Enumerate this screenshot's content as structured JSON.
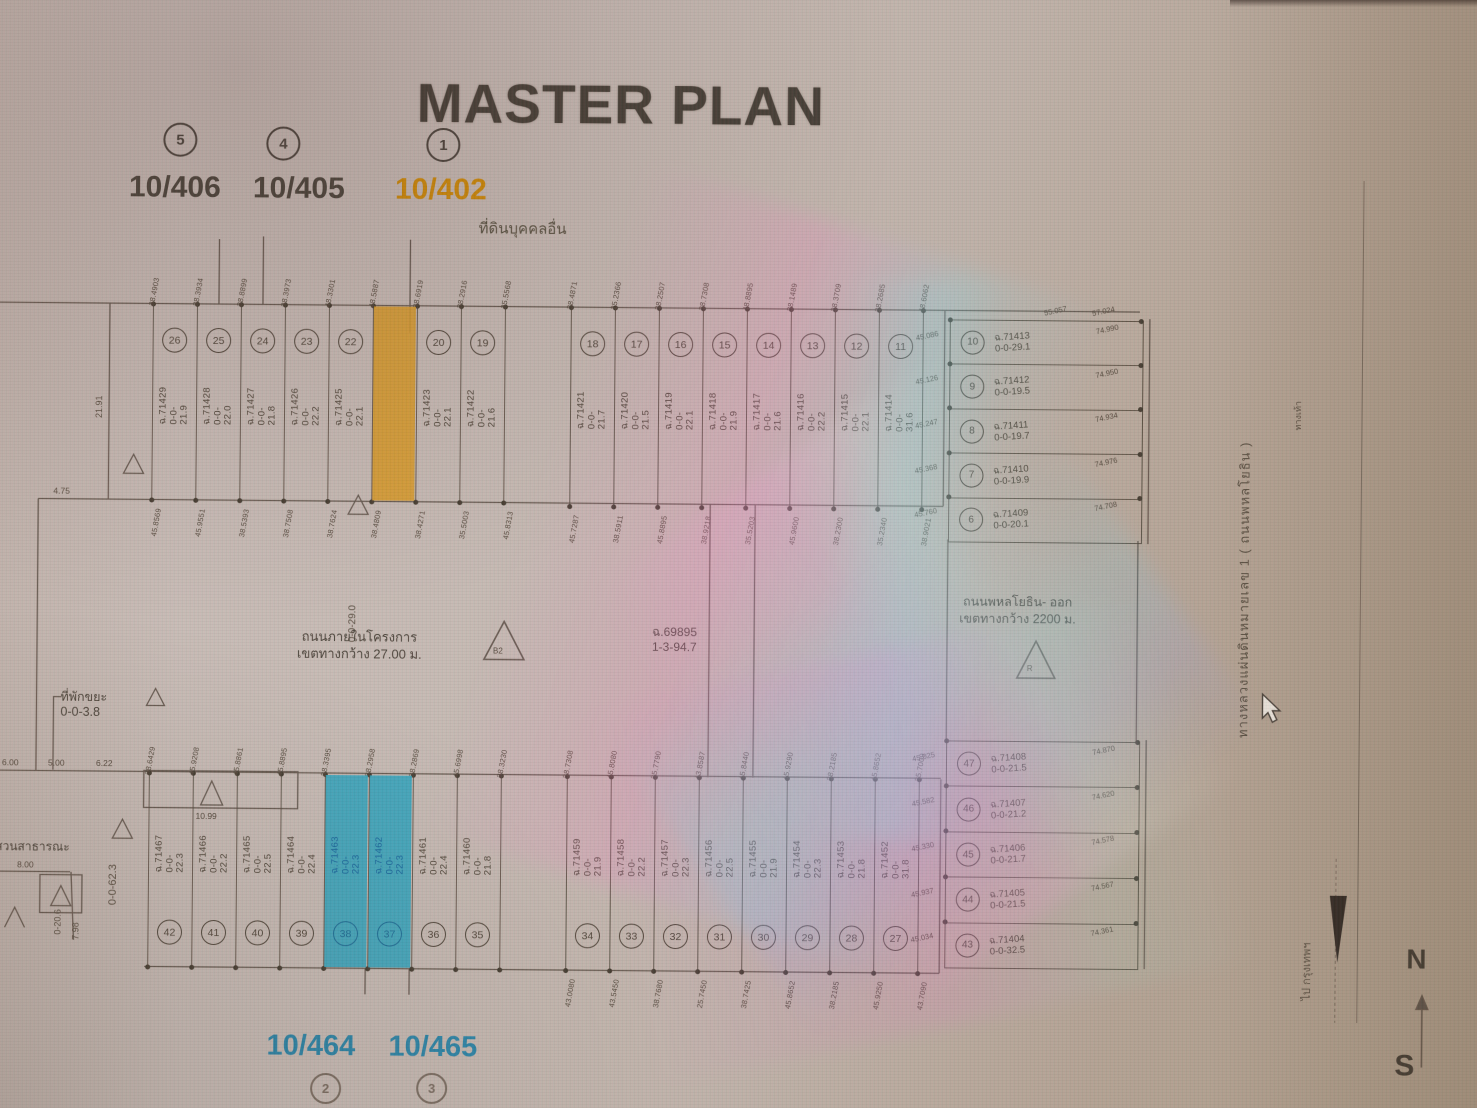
{
  "header": {
    "title": "MASTER PLAN",
    "neighbor_label": "ที่ดินบุคคลอื่น"
  },
  "markers_top": [
    {
      "no": "5",
      "label": "10/406",
      "style": "dark"
    },
    {
      "no": "4",
      "label": "10/405",
      "style": "dark"
    },
    {
      "no": "1",
      "label": "10/402",
      "style": "orange"
    }
  ],
  "markers_bottom": [
    {
      "no": "2",
      "label": "10/464"
    },
    {
      "no": "3",
      "label": "10/465"
    }
  ],
  "colors": {
    "highlight_orange": "#d79a2a",
    "highlight_teal": "#35a3bb",
    "teal_text": "#17669c",
    "orange_text": "#cf8a05",
    "line": "#55493e"
  },
  "lots": {
    "top_left": [
      {
        "no": "26",
        "deed": "ฉ.71429",
        "area": "0-0-21.9",
        "hl": ""
      },
      {
        "no": "25",
        "deed": "ฉ.71428",
        "area": "0-0-22.0",
        "hl": ""
      },
      {
        "no": "24",
        "deed": "ฉ.71427",
        "area": "0-0-21.8",
        "hl": ""
      },
      {
        "no": "23",
        "deed": "ฉ.71426",
        "area": "0-0-22.2",
        "hl": ""
      },
      {
        "no": "22",
        "deed": "ฉ.71425",
        "area": "0-0-22.1",
        "hl": ""
      },
      {
        "no": "",
        "deed": "",
        "area": "",
        "hl": "orange"
      },
      {
        "no": "20",
        "deed": "ฉ.71423",
        "area": "0-0-22.1",
        "hl": ""
      },
      {
        "no": "19",
        "deed": "ฉ.71422",
        "area": "0-0-21.6",
        "hl": ""
      }
    ],
    "top_right": [
      {
        "no": "18",
        "deed": "ฉ.71421",
        "area": "0-0-21.7",
        "hl": ""
      },
      {
        "no": "17",
        "deed": "ฉ.71420",
        "area": "0-0-21.5",
        "hl": ""
      },
      {
        "no": "16",
        "deed": "ฉ.71419",
        "area": "0-0-22.1",
        "hl": ""
      },
      {
        "no": "15",
        "deed": "ฉ.71418",
        "area": "0-0-21.9",
        "hl": ""
      },
      {
        "no": "14",
        "deed": "ฉ.71417",
        "area": "0-0-21.6",
        "hl": ""
      },
      {
        "no": "13",
        "deed": "ฉ.71416",
        "area": "0-0-22.2",
        "hl": ""
      },
      {
        "no": "12",
        "deed": "ฉ.71415",
        "area": "0-0-22.1",
        "hl": ""
      },
      {
        "no": "11",
        "deed": "ฉ.71414",
        "area": "0-0-31.6",
        "hl": ""
      }
    ],
    "bottom_left": [
      {
        "no": "42",
        "deed": "ฉ.71467",
        "area": "0-0-22.3",
        "hl": ""
      },
      {
        "no": "41",
        "deed": "ฉ.71466",
        "area": "0-0-22.2",
        "hl": ""
      },
      {
        "no": "40",
        "deed": "ฉ.71465",
        "area": "0-0-22.5",
        "hl": ""
      },
      {
        "no": "39",
        "deed": "ฉ.71464",
        "area": "0-0-22.4",
        "hl": ""
      },
      {
        "no": "38",
        "deed": "ฉ.71463",
        "area": "0-0-22.3",
        "hl": "teal"
      },
      {
        "no": "37",
        "deed": "ฉ.71462",
        "area": "0-0-22.3",
        "hl": "teal"
      },
      {
        "no": "36",
        "deed": "ฉ.71461",
        "area": "0-0-22.4",
        "hl": ""
      },
      {
        "no": "35",
        "deed": "ฉ.71460",
        "area": "0-0-21.8",
        "hl": ""
      }
    ],
    "bottom_right": [
      {
        "no": "34",
        "deed": "ฉ.71459",
        "area": "0-0-21.9",
        "hl": ""
      },
      {
        "no": "33",
        "deed": "ฉ.71458",
        "area": "0-0-22.2",
        "hl": ""
      },
      {
        "no": "32",
        "deed": "ฉ.71457",
        "area": "0-0-22.3",
        "hl": ""
      },
      {
        "no": "31",
        "deed": "ฉ.71456",
        "area": "0-0-22.5",
        "hl": ""
      },
      {
        "no": "30",
        "deed": "ฉ.71455",
        "area": "0-0-21.9",
        "hl": ""
      },
      {
        "no": "29",
        "deed": "ฉ.71454",
        "area": "0-0-22.3",
        "hl": ""
      },
      {
        "no": "28",
        "deed": "ฉ.71453",
        "area": "0-0-21.8",
        "hl": ""
      },
      {
        "no": "27",
        "deed": "ฉ.71452",
        "area": "0-0-31.8",
        "hl": ""
      }
    ],
    "block_top_right": [
      {
        "no": "10",
        "deed": "ฉ.71413",
        "area": "0-0-29.1"
      },
      {
        "no": "9",
        "deed": "ฉ.71412",
        "area": "0-0-19.5"
      },
      {
        "no": "8",
        "deed": "ฉ.71411",
        "area": "0-0-19.7"
      },
      {
        "no": "7",
        "deed": "ฉ.71410",
        "area": "0-0-19.9"
      },
      {
        "no": "6",
        "deed": "ฉ.71409",
        "area": "0-0-20.1"
      }
    ],
    "block_bottom_right": [
      {
        "no": "47",
        "deed": "ฉ.71408",
        "area": "0-0-21.5"
      },
      {
        "no": "46",
        "deed": "ฉ.71407",
        "area": "0-0-21.2"
      },
      {
        "no": "45",
        "deed": "ฉ.71406",
        "area": "0-0-21.7"
      },
      {
        "no": "44",
        "deed": "ฉ.71405",
        "area": "0-0-21.5"
      },
      {
        "no": "43",
        "deed": "ฉ.71404",
        "area": "0-0-32.5"
      }
    ]
  },
  "ticks": {
    "top_left_above": [
      "38.4903",
      "38.3934",
      "38.8899",
      "38.3973",
      "48.3301",
      "48.5887",
      "38.6919",
      "38.2916",
      "35.5568"
    ],
    "top_right_above": [
      "38.4871",
      "25.2366",
      "38.2507",
      "38.7308",
      "48.8895",
      "38.1489",
      "38.3709",
      "38.2685",
      "48.6062"
    ],
    "top_left_below": [
      "45.8569",
      "45.9551",
      "38.5393",
      "38.7508",
      "38.7624",
      "38.4809",
      "38.4271",
      "35.5003",
      "45.8313"
    ],
    "top_right_below": [
      "45.7287",
      "38.5911",
      "45.8895",
      "38.9218",
      "35.5203",
      "45.9600",
      "38.2300",
      "35.2340",
      "38.9021"
    ],
    "bottom_left_above": [
      "38.6429",
      "45.9208",
      "45.8861",
      "45.8895",
      "38.3395",
      "38.2958",
      "38.2869",
      "45.6998",
      "38.3230"
    ],
    "bottom_right_above": [
      "38.7308",
      "45.8080",
      "25.7790",
      "43.8587",
      "45.8440",
      "45.9290",
      "38.2185",
      "45.8652",
      "25.7009"
    ],
    "bottom_right_below": [
      "43.0080",
      "43.5450",
      "38.7680",
      "25.7450",
      "38.7425",
      "45.8652",
      "38.2185",
      "45.9250",
      "43.7090"
    ],
    "btr_left": [
      "45.086",
      "45.126",
      "45.247",
      "45.368",
      "45.760"
    ],
    "btr_right": [
      "74.990",
      "74.950",
      "74.934",
      "74.976",
      "74.708"
    ],
    "btr_top": [
      "55.057",
      "57.024"
    ],
    "bbr_left": [
      "45.025",
      "45.582",
      "45.330",
      "45.937",
      "45.034"
    ],
    "bbr_right": [
      "74.870",
      "74.620",
      "74.578",
      "74.567",
      "74.361"
    ]
  },
  "roads": {
    "internal": {
      "line1": "ถนนภายในโครงการ",
      "line2": "เขตทางกว้าง 27.00 ม.",
      "sym": "B2"
    },
    "exit": {
      "line1": "ถนนพหลโยธิน- ออก",
      "line2": "เขตทางกว้าง 2200 ม.",
      "sym": "R"
    }
  },
  "annotations": {
    "parcel_deed": "ฉ.69895",
    "parcel_area": "1-3-94.7",
    "waste_label": "ที่พักขยะ",
    "waste_area": "0-0-3.8",
    "park_label": "สวนสาธารณะ",
    "park_area": "0-0-62.3",
    "mid_area": "0-0-29.0"
  },
  "dims": {
    "left_top": "21.91",
    "left_mid": "4.75",
    "d1": "6.00",
    "d2": "5.00",
    "d3": "6.22",
    "rect": "10.99",
    "park_w": "8.00",
    "park_h": "0-20.6",
    "park_h2": "7.98"
  },
  "side": {
    "highway": "ทางหลวงแผ่นดินหมายเลข 1 ( ถนนพหลโยธิน )",
    "walk": "ทางเท้า",
    "south": "ไป กรุงเทพฯ"
  },
  "compass": {
    "n": "N",
    "s": "S"
  }
}
